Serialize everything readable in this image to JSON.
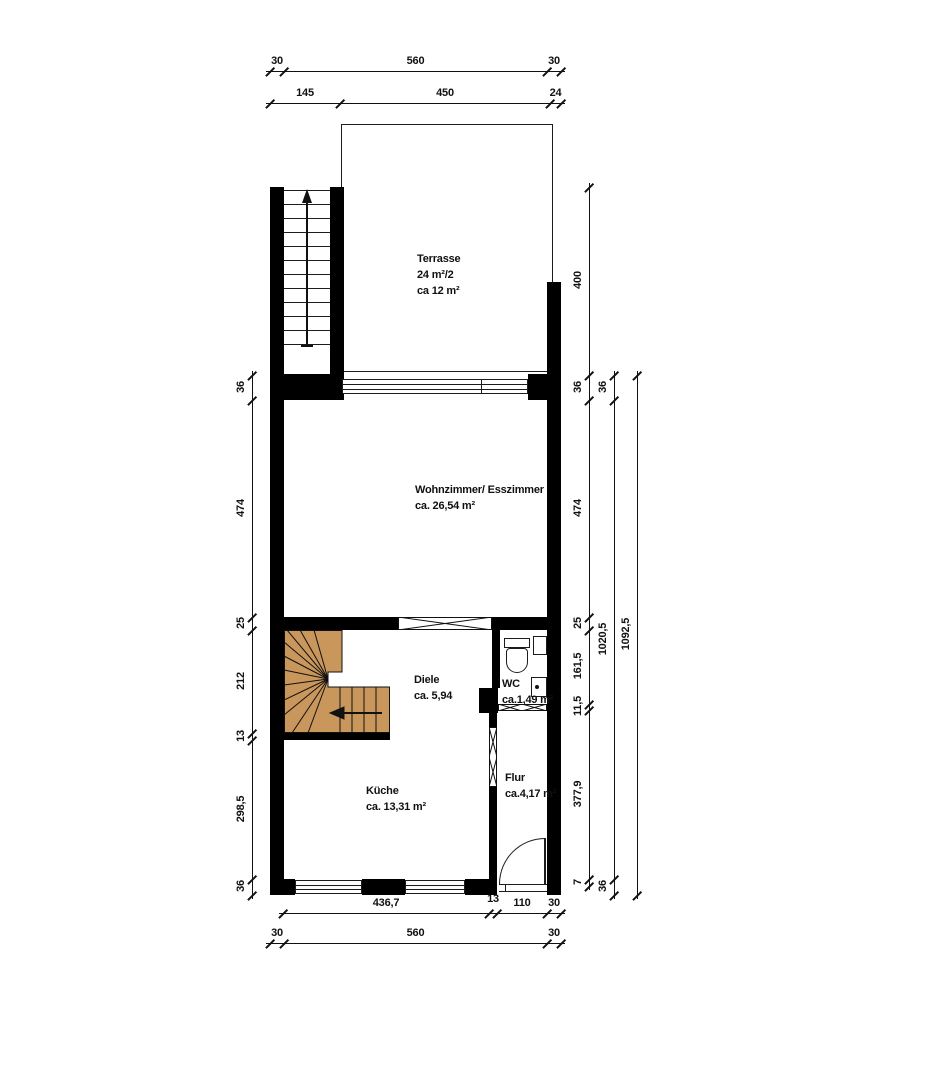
{
  "document": {
    "type": "architectural-floor-plan",
    "background": "#ffffff"
  },
  "colors": {
    "background": "#ffffff",
    "wall": "#000000",
    "line": "#1c1c1c",
    "dimension": "#111111",
    "text": "#111111",
    "stair_fill": "#c9965c"
  },
  "rooms": {
    "terrasse": {
      "name": "Terrasse",
      "line2": "24 m²/2",
      "line3": "ca 12 m²"
    },
    "wohnzimmer": {
      "name": "Wohnzimmer/ Esszimmer",
      "area": "ca. 26,54 m²"
    },
    "diele": {
      "name": "Diele",
      "area": "ca. 5,94"
    },
    "wc": {
      "name": "WC",
      "area": "ca.1,49 m²"
    },
    "kueche": {
      "name": "Küche",
      "area": "ca. 13,31 m²"
    },
    "flur": {
      "name": "Flur",
      "area": "ca.4,17 m²"
    }
  },
  "symbols": {
    "exterior_stair_arrow": "up-arrow",
    "winder_stair_arrow": "left-arrow",
    "entrance_door": "quarter-circle-swing",
    "wc_fixtures": [
      "toilet",
      "cistern",
      "washbasin"
    ]
  },
  "exterior_stair": {
    "treads": 12
  },
  "dimensions": {
    "chains": [
      {
        "id": "top-outer",
        "orient": "h",
        "line": 71,
        "ticks": [
          270,
          284,
          547,
          561
        ],
        "labels": [
          "30",
          "560",
          "30"
        ]
      },
      {
        "id": "top-inner",
        "orient": "h",
        "line": 103,
        "ticks": [
          270,
          340,
          550,
          561
        ],
        "labels": [
          "145",
          "450",
          "24"
        ]
      },
      {
        "id": "left",
        "orient": "v",
        "line": 252,
        "ticks": [
          375,
          400,
          617,
          630,
          733,
          740,
          879,
          895
        ],
        "labels": [
          "36",
          "474",
          "25",
          "212",
          "13",
          "298,5",
          "36"
        ]
      },
      {
        "id": "right-inner",
        "orient": "v",
        "line": 589,
        "ticks": [
          187,
          375,
          400,
          617,
          630,
          704,
          710,
          879,
          886
        ],
        "labels": [
          "400",
          "36",
          "474",
          "25",
          "161,5",
          "11,5",
          "377,9",
          "7"
        ]
      },
      {
        "id": "right-mid",
        "orient": "v",
        "line": 614,
        "ticks": [
          375,
          400,
          879,
          895
        ],
        "labels": [
          "36",
          "1020,5",
          "36"
        ]
      },
      {
        "id": "right-outer",
        "orient": "v",
        "line": 637,
        "ticks": [
          375,
          895
        ],
        "labels": [
          "1092,5"
        ]
      },
      {
        "id": "bottom-inner",
        "orient": "h",
        "line": 913,
        "ticks": [
          283,
          489,
          497,
          547,
          561
        ],
        "labels": [
          "436,7",
          "13",
          "110",
          "30"
        ],
        "label_dy": [
          0,
          -4,
          0,
          0
        ]
      },
      {
        "id": "bottom-outer",
        "orient": "h",
        "line": 943,
        "ticks": [
          270,
          284,
          547,
          561
        ],
        "labels": [
          "30",
          "560",
          "30"
        ]
      }
    ]
  }
}
